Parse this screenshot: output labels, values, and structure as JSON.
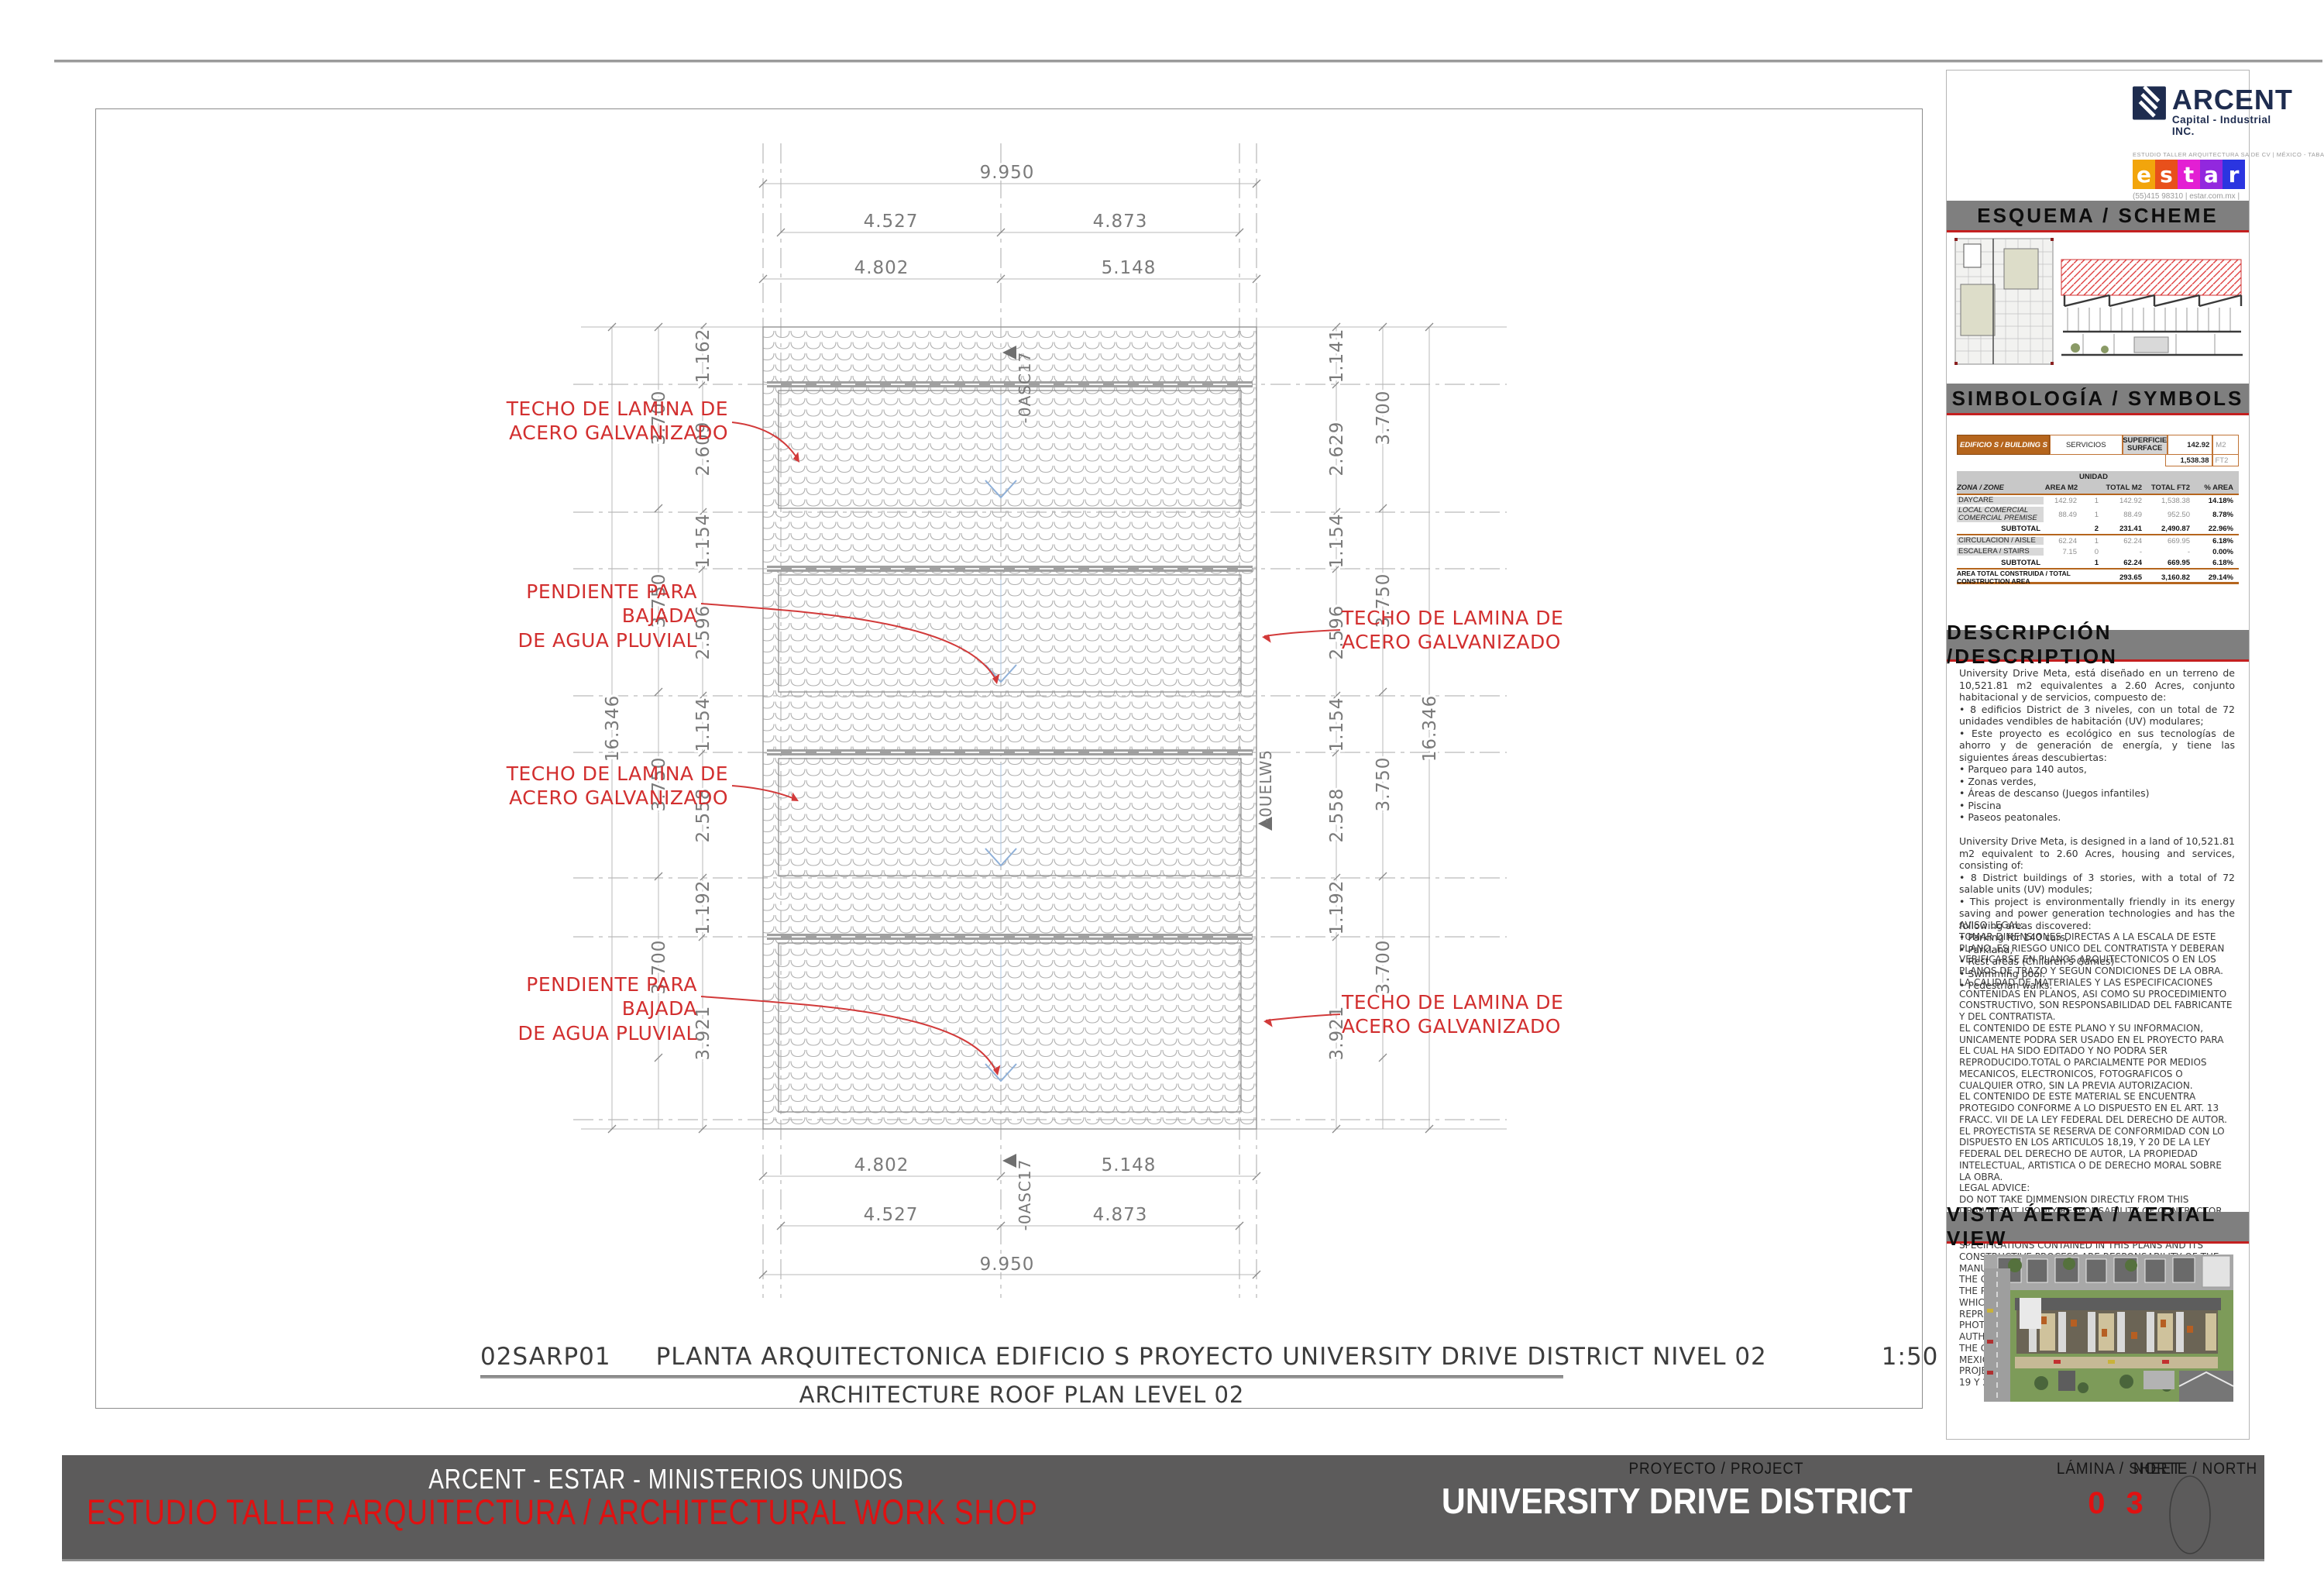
{
  "plan": {
    "title_code": "02SARP01",
    "title_text": "PLANTA ARQUITECTONICA EDIFICIO S   PROYECTO UNIVERSITY DRIVE DISTRICT NIVEL 02",
    "title_scale": "1:50",
    "subtitle": "ARCHITECTURE ROOF PLAN LEVEL 02",
    "annotations": {
      "techo": "TECHO DE LAMINA DE\nACERO GALVANIZADO",
      "pendiente": "PENDIENTE PARA BAJADA\nDE AGUA PLUVIAL"
    },
    "markers": {
      "asc": "-0ASC17",
      "uelw": "-0UELW5"
    },
    "dims": {
      "top_overall": "9.950",
      "top_upper_left": "4.527",
      "top_upper_right": "4.873",
      "top_lower_left": "4.802",
      "top_lower_right": "5.148",
      "bottom_upper_left": "4.802",
      "bottom_upper_right": "5.148",
      "bottom_lower_left": "4.527",
      "bottom_lower_right": "4.873",
      "bottom_overall": "9.950",
      "left_inner": [
        "1.162",
        "2.609",
        "1.154",
        "2.596",
        "1.154",
        "2.558",
        "1.192",
        "3.921"
      ],
      "left_outer": [
        "3.700",
        "3.750",
        "3.750",
        "3.700"
      ],
      "left_overall": "16.346",
      "right_inner": [
        "1.141",
        "2.629",
        "1.154",
        "2.596",
        "1.154",
        "2.558",
        "1.192",
        "3.921"
      ],
      "right_outer": [
        "3.700",
        "3.750",
        "3.750",
        "3.700"
      ],
      "right_overall": "16.346"
    }
  },
  "titleblock": {
    "arcent": {
      "name": "ARCENT",
      "tagline": "Capital - Industrial INC."
    },
    "estar": {
      "top": "ESTUDIO TALLER ARQUITECTURA SA DE CV | MÉXICO - TABASCO - FLORIDA",
      "letters": {
        "l0": "e",
        "l1": "s",
        "l2": "t",
        "l3": "a",
        "l4": "r"
      },
      "colors": [
        "#F2A50C",
        "#E8501B",
        "#E31FD3",
        "#9228DE",
        "#2B35E0"
      ],
      "contact": "(55)415 98310    |    estar.com.mx |\ninfo@estar.com.mx"
    },
    "sections": {
      "esquema": "ESQUEMA / SCHEME",
      "simbologia": "SIMBOLOGÍA / SYMBOLS",
      "descripcion": "DESCRIPCIÓN /DESCRIPTION",
      "vista": "VISTA ÁEREA / AERIAL VIEW"
    },
    "symbols_table": {
      "building": "EDIFICIO S / BUILDING S",
      "service": "SERVICIOS",
      "surface_label": "SUPERFICIE\nSURFACE",
      "m2_value": "142.92",
      "m2_unit": "M2",
      "ft2_value": "1,538.38",
      "ft2_unit": "FT2",
      "unidad": "UNIDAD",
      "col_zone": "ZONA / ZONE",
      "col_area": "AREA M2",
      "col_total_m2": "TOTAL M2",
      "col_total_ft2": "TOTAL FT2",
      "col_pct": "% AREA",
      "rows": [
        {
          "zone": "DAYCARE",
          "area": "142.92",
          "unit": "1",
          "total_m2": "142.92",
          "total_ft2": "1,538.38",
          "pct": "14.18%"
        },
        {
          "zone": "LOCAL COMERCIAL\nCOMERCIAL PREMISE",
          "area": "88.49",
          "unit": "1",
          "total_m2": "88.49",
          "total_ft2": "952.50",
          "pct": "8.78%"
        },
        {
          "zone": "SUBTOTAL",
          "area": "",
          "unit": "2",
          "total_m2": "231.41",
          "total_ft2": "2,490.87",
          "pct": "22.96%"
        },
        {
          "zone": "CIRCULACION  / AISLE",
          "area": "62.24",
          "unit": "1",
          "total_m2": "62.24",
          "total_ft2": "669.95",
          "pct": "6.18%"
        },
        {
          "zone": "ESCALERA / STAIRS",
          "area": "7.15",
          "unit": "0",
          "total_m2": "-",
          "total_ft2": "-",
          "pct": "0.00%"
        },
        {
          "zone": "SUBTOTAL",
          "area": "",
          "unit": "1",
          "total_m2": "62.24",
          "total_ft2": "669.95",
          "pct": "6.18%"
        }
      ],
      "total_label": "AREA TOTAL CONSTRUIDA  / TOTAL CONSTRUCTION AREA",
      "total_m2": "293.65",
      "total_ft2": "3,160.82",
      "total_pct": "29.14%"
    },
    "description": "University Drive Meta, está diseñado en un terreno de 10,521.81 m2 equivalentes a 2.60 Acres, conjunto habitacional y de servicios, compuesto de:\n•    8 edificios District de 3 niveles, con un total de 72 unidades vendibles de habitación (UV) modulares;\n•    Este proyecto es ecológico en sus tecnologías de ahorro y de generación de energía, y tiene las siguientes áreas descubiertas:\n        •       Parqueo para 140 autos,\n        •       Zonas verdes,\n        •       Áreas de descanso (Juegos infantiles)\n        •       Piscina\n        •       Paseos peatonales.\n\nUniversity Drive Meta, is designed in a land of 10,521.81 m2 equivalent to 2.60 Acres, housing and services, consisting of:\n•    8 District buildings of 3 stories, with a total of 72 salable units (UV) modules;\n•    This project is environmentally friendly in its energy saving and power generation technologies and has the following areas discovered:\n        •       Parking for 140 cars,\n        •       Parkland,\n        •       Rest areas (Children's Games)\n        •       Swimming pool.\n        •       Pedestrian walks.",
    "legal": "AVISO LEGAL:\nTOMAR DIMENSIONES DIRECTAS A LA ESCALA DE ESTE PLANO, ES RIESGO UNICO DEL CONTRATISTA Y DEBERAN VERIFICARSE EN PLANOS ARQUITECTONICOS O EN LOS PLANOS DE TRAZO Y SEGÚN CONDICIONES DE LA OBRA. LA CALIDAD DE MATERIALES Y LAS ESPECIFICACIONES CONTENIDAS EN PLANOS, ASI COMO SU PROCEDIMIENTO CONSTRUCTIVO, SON RESPONSABILIDAD DEL FABRICANTE Y DEL CONTRATISTA.\nEL CONTENIDO DE ESTE PLANO Y SU INFORMACION, UNICAMENTE PODRA SER USADO EN EL PROYECTO PARA EL CUAL HA SIDO EDITADO Y NO PODRA SER REPRODUCIDO.TOTAL O PARCIALMENTE POR MEDIOS MECANICOS, ELECTRONICOS, FOTOGRAFICOS O CUALQUIER OTRO, SIN LA PREVIA AUTORIZACION.\nEL CONTENIDO DE ESTE MATERIAL SE ENCUENTRA PROTEGIDO CONFORME A LO DISPUESTO EN EL ART. 13 FRACC. VII DE LA LEY FEDERAL DEL DERECHO DE AUTOR. EL PROYECTISTA SE RESERVA DE CONFORMIDAD CON LO DISPUESTO EN LOS ARTICULOS 18,19, Y 20  DE LA LEY FEDERAL DEL DERECHO DE AUTOR, LA PROPIEDAD INTELECTUAL, ARTISTICA O DE DERECHO MORAL SOBRE LA OBRA.\nLEGAL ADVICE:\nDO NOT TAKE DIMMENSION DIRECTLY FROM THIS DRAWING, IT IS ONLY RESPONSABILITY OF CONTRACTOR AND MUST VERIFY IN PLANS OF ARCHITECTURE\nAND TRACE AND OTHER SITE AND CONSTRUCTION SPECIFICATIONS CONTAINED IN THIS PLANS AND ITS CONSTRUCTIVE PROCESS ARE RESPONSABILITY OF THE MANUFACTURER AND THE CONSTRUCTOR ONLY.\nTHE CONTENT OF THIS PLAN AND THE INFORMATION OF THE PROJECT CAN ONLY BE USED IN THE PROJECT FOR WHICH IT HAS BEEN PREPARED. IT CANNOT BE REPRODUCED TOTALLY OR PARTIALLY FOR MECHANICAL, PHOTOGRAPHICAL OR DIGITAL MEDIA WITH OUT PREVIOS AUTHORIZATION OF THE ARCHITECT.\nTHE CONTENT OF THIS MATERIAL IS PROTECTED BY MEXICAN LAW OF COPYRIGHT ART. 13 FRACT. VII AND THE PROJECT AUTHOR RESERVES IT ACCORDING TO ART. 18, 19 Y 20 THE MENTIONED LAW."
  },
  "footer": {
    "company_line": "ARCENT - ESTAR - MINISTERIOS UNIDOS",
    "studio_line": "ESTUDIO TALLER ARQUITECTURA  / ARCHITECTURAL WORK SHOP",
    "project_label": "PROYECTO / PROJECT",
    "project_name": "UNIVERSITY DRIVE DISTRICT",
    "sheet_label": "LÁMINA / SHEET",
    "sheet_number": "0 3",
    "north_label": "NORTE / NORTH"
  }
}
